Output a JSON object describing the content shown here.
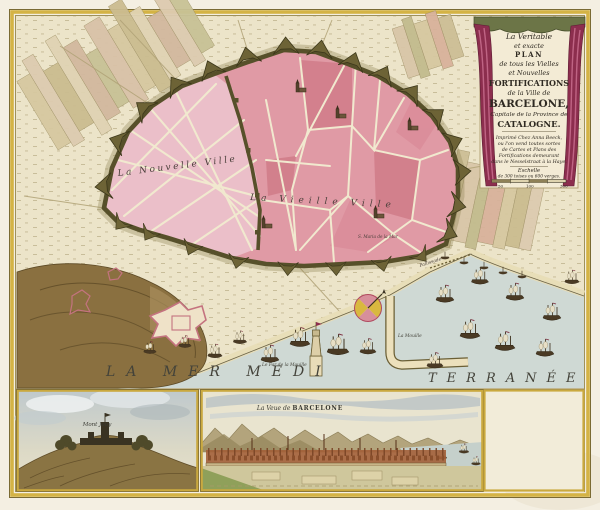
{
  "cartouche": {
    "title_line1": "La Veritable",
    "title_line2": "et exacte",
    "title_line3": "PLAN",
    "title_line4": "de tous les Vielles",
    "title_line5": "et Nouvelles",
    "title_line6": "FORTIFICATIONS",
    "title_line7": "de la Ville de",
    "title_line8": "BARCELONE,",
    "title_line9": "Capitale de la Province de",
    "title_line10": "CATALOGNE.",
    "imprint_line1": "Imprimé Chez Anna Beeck,",
    "imprint_line2": "ou l'on vend toutes sortes",
    "imprint_line3": "de Cartes et Plans des",
    "imprint_line4": "Fortifications demeurant",
    "imprint_line5": "dans le Nesselstraat à la Haye.",
    "scale_title": "Eschelle",
    "scale_subtitle": "de 300 toises ou 600 verges.",
    "scale_tick1": "50",
    "scale_tick2": "100",
    "scale_tick3": "300"
  },
  "map": {
    "label_new_town": "La Nouvelle Ville",
    "label_old_town": "La Vieille Ville",
    "label_sea_left": "LA MER MEDI",
    "label_sea_right": "TERRANÉE",
    "label_lighthouse": "Le Far de la Mouille",
    "label_mole": "La Mouille",
    "label_palisade": "Pallissade",
    "label_church": "S. Maria de la Mar"
  },
  "insets": {
    "montjuic_label": "Mont Jouy",
    "panorama_label_script": "La Veue de ",
    "panorama_label_caps": "BARCELONE"
  },
  "colors": {
    "accent_gold": "#d4b345",
    "city_pink": "#e09aa5",
    "wall_olive": "#57502a",
    "sea": "#cfd9d4",
    "drapery_crimson": "#8c2e4e"
  }
}
